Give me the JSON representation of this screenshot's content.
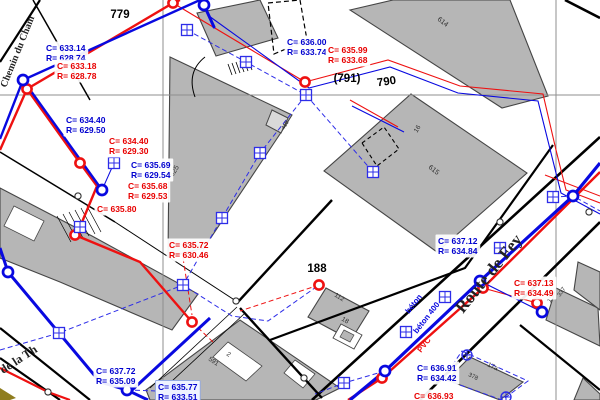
{
  "map": {
    "colors": {
      "water_blue": "#0909e0",
      "sewer_red": "#ee1111",
      "dashed_blue": "#2d2de8",
      "building_fill": "#b6b6b6",
      "building_edge": "#454545",
      "grid_gray": "#8f8f8f",
      "parcel_black": "#000000",
      "label_blue": "#0000cf",
      "label_red": "#e80000"
    },
    "grid": {
      "vertical_x": [
        163,
        556
      ],
      "horizontal_y": [
        95
      ]
    },
    "parcel_labels": [
      {
        "text": "779",
        "x": 120,
        "y": 18,
        "rotate": 0
      },
      {
        "text": "(791)",
        "x": 347,
        "y": 82,
        "rotate": 0
      },
      {
        "text": "790",
        "x": 387,
        "y": 85,
        "rotate": -8
      },
      {
        "text": "188",
        "x": 317,
        "y": 272,
        "rotate": 0
      }
    ],
    "street_labels": [
      {
        "text": "Chemin du Cham",
        "x": 6,
        "y": 88,
        "rotate": -68,
        "size": 10
      },
      {
        "text": "Route de Fey",
        "x": 463,
        "y": 314,
        "rotate": -51,
        "size": 17
      },
      {
        "text": "de la Th",
        "x": 3,
        "y": 374,
        "rotate": -33,
        "size": 12
      }
    ],
    "pipe_labels": [
      {
        "text": "béton",
        "x": 409,
        "y": 314,
        "rotate": -52,
        "color": "#0909e0"
      },
      {
        "text": "béton 400",
        "x": 417,
        "y": 334,
        "rotate": -52,
        "color": "#0909e0"
      },
      {
        "text": "PVC",
        "x": 421,
        "y": 353,
        "rotate": -52,
        "color": "#ee1111"
      }
    ],
    "building_labels": [
      {
        "text": "614",
        "x": 437,
        "y": 20,
        "rotate": 38,
        "size": 7
      },
      {
        "text": "615",
        "x": 428,
        "y": 168,
        "rotate": 38,
        "size": 7
      },
      {
        "text": "16",
        "x": 417,
        "y": 133,
        "rotate": -58,
        "size": 6.5
      },
      {
        "text": "625",
        "x": 173,
        "y": 177,
        "rotate": -58,
        "size": 7
      },
      {
        "text": "415",
        "x": 284,
        "y": 130,
        "rotate": -58,
        "size": 5.5
      },
      {
        "text": "112",
        "x": 334,
        "y": 296,
        "rotate": 32,
        "size": 6.5
      },
      {
        "text": "18",
        "x": 341,
        "y": 320,
        "rotate": 32,
        "size": 6.5
      },
      {
        "text": "591",
        "x": 208,
        "y": 360,
        "rotate": 34,
        "size": 6.5
      },
      {
        "text": "2",
        "x": 226,
        "y": 355,
        "rotate": 34,
        "size": 6.5
      },
      {
        "text": "17a",
        "x": 487,
        "y": 366,
        "rotate": 25,
        "size": 6.5
      },
      {
        "text": "378",
        "x": 468,
        "y": 376,
        "rotate": 25,
        "size": 6
      },
      {
        "text": "15",
        "x": 550,
        "y": 303,
        "rotate": -55,
        "size": 6.5
      },
      {
        "text": "337",
        "x": 560,
        "y": 297,
        "rotate": -55,
        "size": 6
      }
    ],
    "annotations": [
      {
        "c": "C= 633.14",
        "r": "R= 628.74",
        "x": 46,
        "y": 51,
        "color": "blue"
      },
      {
        "c": "C= 633.18",
        "r": "R= 628.78",
        "x": 57,
        "y": 69,
        "color": "red"
      },
      {
        "c": "C= 634.40",
        "r": "R= 629.50",
        "x": 66,
        "y": 123,
        "color": "blue"
      },
      {
        "c": "C= 634.40",
        "r": "R= 629.30",
        "x": 109,
        "y": 144,
        "color": "red"
      },
      {
        "c": "C= 635.69",
        "r": "R= 629.54",
        "x": 131,
        "y": 168,
        "color": "blue"
      },
      {
        "c": "C= 635.68",
        "r": "R= 629.53",
        "x": 128,
        "y": 189,
        "color": "red"
      },
      {
        "c": "C= 635.80",
        "r": null,
        "x": 97,
        "y": 212,
        "color": "red"
      },
      {
        "c": "C= 635.72",
        "r": "R= 630.46",
        "x": 169,
        "y": 248,
        "color": "red"
      },
      {
        "c": "C= 636.00",
        "r": "R= 633.74",
        "x": 287,
        "y": 45,
        "color": "blue"
      },
      {
        "c": "C= 635.99",
        "r": "R= 633.68",
        "x": 328,
        "y": 53,
        "color": "red"
      },
      {
        "c": "C= 637.12",
        "r": "R= 634.84",
        "x": 438,
        "y": 244,
        "color": "blue"
      },
      {
        "c": "C= 637.13",
        "r": "R= 634.49",
        "x": 514,
        "y": 286,
        "color": "red"
      },
      {
        "c": "C= 637.72",
        "r": "R= 635.09",
        "x": 96,
        "y": 374,
        "color": "blue"
      },
      {
        "c": "C= 635.77",
        "r": "R= 633.51",
        "x": 158,
        "y": 390,
        "color": "blue",
        "boxed": true
      },
      {
        "c": "C= 636.91",
        "r": "R= 634.42",
        "x": 417,
        "y": 371,
        "color": "blue"
      },
      {
        "c": "C= 636.93",
        "r": null,
        "x": 414,
        "y": 399,
        "color": "red"
      }
    ],
    "symbols": {
      "sewer_nodes": [
        [
          173,
          3
        ],
        [
          27,
          89
        ],
        [
          80,
          163
        ],
        [
          75,
          235
        ],
        [
          192,
          322
        ],
        [
          319,
          285
        ],
        [
          305,
          82
        ],
        [
          483,
          288
        ],
        [
          537,
          303
        ],
        [
          382,
          378
        ]
      ],
      "water_nodes": [
        [
          204,
          5
        ],
        [
          23,
          80
        ],
        [
          102,
          190
        ],
        [
          8,
          272
        ],
        [
          127,
          390
        ],
        [
          573,
          196
        ],
        [
          480,
          281
        ],
        [
          385,
          371
        ],
        [
          542,
          312
        ]
      ],
      "grid_squares": [
        [
          187,
          30
        ],
        [
          246,
          62
        ],
        [
          306,
          95
        ],
        [
          114,
          163
        ],
        [
          80,
          227
        ],
        [
          373,
          172
        ],
        [
          260,
          153
        ],
        [
          222,
          218
        ],
        [
          183,
          285
        ],
        [
          59,
          333
        ],
        [
          344,
          383
        ],
        [
          406,
          332
        ],
        [
          553,
          197
        ],
        [
          445,
          297
        ],
        [
          500,
          248
        ]
      ],
      "survey_points": [
        [
          467,
          355
        ],
        [
          506,
          397
        ]
      ],
      "boundary_stones": [
        [
          78,
          196
        ],
        [
          236,
          301
        ],
        [
          48,
          392
        ],
        [
          304,
          378
        ],
        [
          500,
          222
        ],
        [
          589,
          212
        ]
      ]
    }
  }
}
